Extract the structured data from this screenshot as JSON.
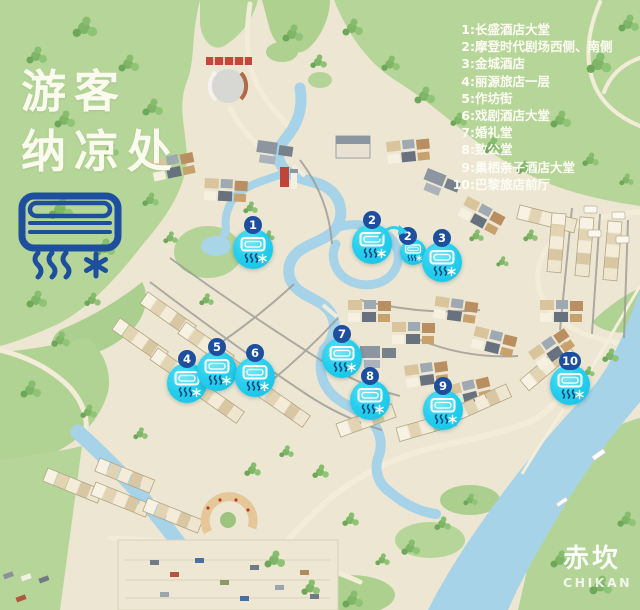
{
  "title": {
    "line1": "游客",
    "line2": "纳凉处"
  },
  "legend": {
    "items": [
      {
        "num": "1:",
        "label": "长盛酒店大堂"
      },
      {
        "num": "2:",
        "label": "摩登时代剧场西侧、南侧"
      },
      {
        "num": "3:",
        "label": "金城酒店"
      },
      {
        "num": "4:",
        "label": "丽源旅店一层"
      },
      {
        "num": "5:",
        "label": "作坊街"
      },
      {
        "num": "6:",
        "label": "戏剧酒店大堂"
      },
      {
        "num": "7:",
        "label": "婚礼堂"
      },
      {
        "num": "8:",
        "label": "致公堂"
      },
      {
        "num": "9:",
        "label": "巢栖亲子酒店大堂"
      },
      {
        "num": "10:",
        "label": "巴黎旅店前厅"
      }
    ]
  },
  "markers": [
    {
      "label": "1"
    },
    {
      "label": "2"
    },
    {
      "label": "2"
    },
    {
      "label": "3"
    },
    {
      "label": "4"
    },
    {
      "label": "5"
    },
    {
      "label": "6"
    },
    {
      "label": "7"
    },
    {
      "label": "8"
    },
    {
      "label": "9"
    },
    {
      "label": "10"
    }
  ],
  "watermark": {
    "cn": "赤坎",
    "en": "CHIKAN"
  },
  "icons": {
    "header_icon": "air-conditioner-icon",
    "marker_icon": "air-conditioner-icon",
    "extras": [
      "airflow-waves-icon",
      "snowflake-asterisk-icon"
    ]
  },
  "colors": {
    "accent_blue": "#1d4f9e",
    "marker_cyan": "#27cfee",
    "text_white": "#fdfdf4",
    "map_green": "#b6d699",
    "water_blue": "#a6d3e7",
    "ground": "#ede6d3"
  }
}
